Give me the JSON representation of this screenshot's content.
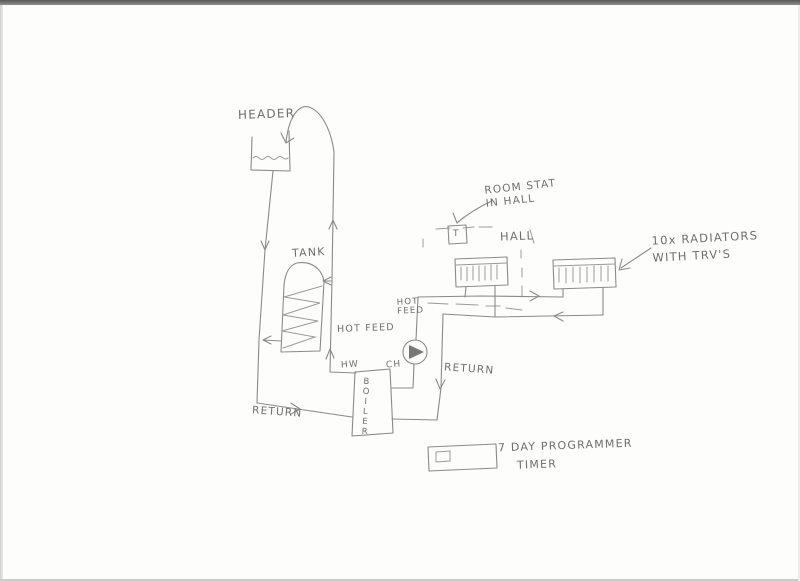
{
  "diagram": {
    "title": "Hand-drawn central heating system sketch",
    "labels": {
      "header": "HEADER",
      "tank": "TANK",
      "hot_feed_tank": "HOT FEED",
      "hot_feed_pump": "HOT\nFEED",
      "room_stat": "ROOM STAT\nIN HALL",
      "hall": "HALL",
      "radiators": "10x RADIATORS\nWITH TRV'S",
      "hw": "HW",
      "ch": "CH",
      "boiler": "BOILER",
      "return_right": "RETURN",
      "return_bottom": "RETURN",
      "programmer_line1": "7 DAY PROGRAMMER",
      "programmer_line2": "TIMER",
      "stat_letter": "T"
    },
    "colors": {
      "paper": "#fdfdfc",
      "pencil": "#8a8a8a",
      "text": "#6e6e6e",
      "scan_edge": "#585858"
    }
  }
}
